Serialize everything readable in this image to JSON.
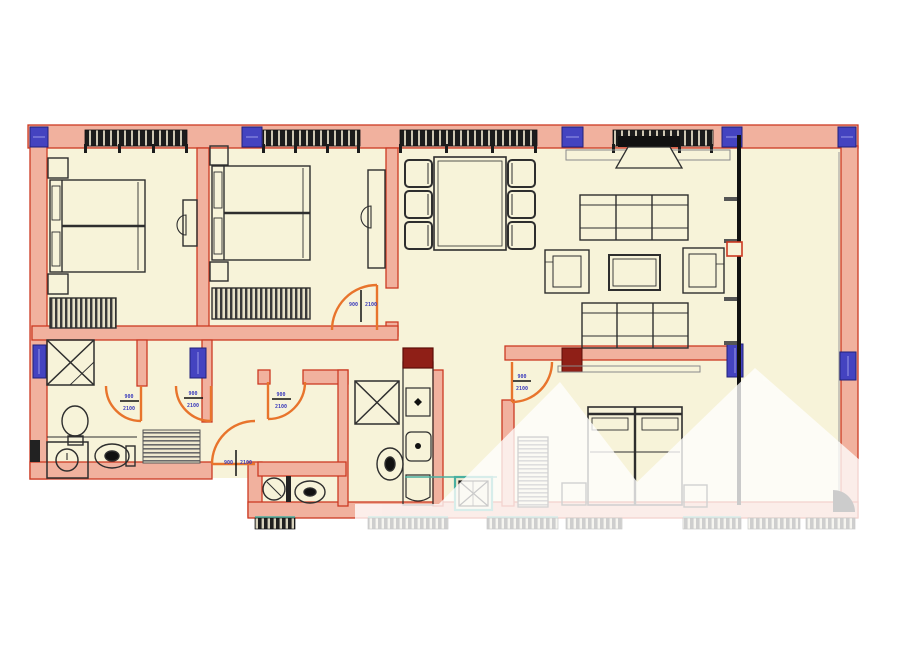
{
  "title": "apartment-floor-plan",
  "colors": {
    "floor": "#f7f3d9",
    "wall_fill": "#f1b19e",
    "wall_line": "#cc3a22",
    "door_arc": "#e8742c",
    "window_band": "#1c1c1c",
    "window_marker_blue": "#4443c0",
    "dimension_label_blue": "#3b3bbb",
    "furniture_line": "#2e2e2e",
    "shaft_teal": "#49b0a0",
    "radiator_dark_red": "#8f1f17",
    "watermark_white": "#ffffff"
  },
  "rooms": {
    "bedroom_1": "top-left bedroom",
    "bedroom_2": "top-center bedroom",
    "dining_area": "dining table with six chairs",
    "living_room": "sofas, armchairs, coffee table, tv",
    "balcony": "right-side balcony strip",
    "bathroom_1": "bottom-left bathroom with shower, sink, washer, toilet",
    "bathroom_2": "central bathroom with shower, toilet, vanity",
    "wc": "small wc near entry",
    "bedroom_3": "bottom-right bedroom",
    "hallway": "central corridor with rug"
  },
  "furniture_icons": [
    "double-bed-icon",
    "nightstand-icon",
    "dresser-icon",
    "desk-stool-icon",
    "dining-table-icon",
    "chair-icon",
    "tv-icon",
    "sofa-icon",
    "armchair-icon",
    "coffee-table-icon",
    "shower-icon",
    "toilet-icon",
    "sink-icon",
    "washing-machine-icon",
    "wardrobe-icon",
    "rug-icon",
    "duct-shaft-icon"
  ],
  "door_labels": [
    {
      "top": "900",
      "bottom": "2100"
    },
    {
      "top": "900",
      "bottom": "2100"
    },
    {
      "top": "900",
      "bottom": "2100"
    },
    {
      "top": "900",
      "bottom": "2100"
    },
    {
      "top": "900",
      "bottom": "2100"
    },
    {
      "top": "900",
      "bottom": "2100"
    }
  ]
}
